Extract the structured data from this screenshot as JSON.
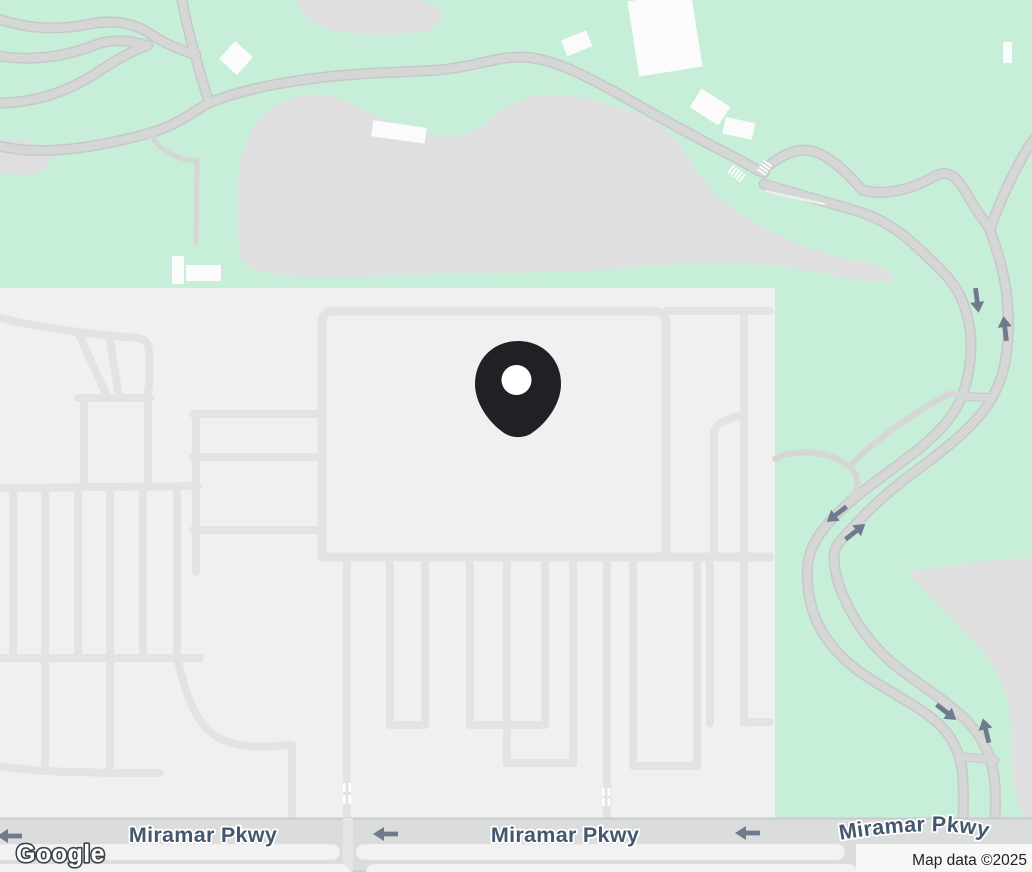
{
  "map": {
    "type": "google-maps-embed",
    "road_labels": [
      {
        "id": "miramar-pkwy-left",
        "text": "Miramar Pkwy"
      },
      {
        "id": "miramar-pkwy-center",
        "text": "Miramar Pkwy"
      },
      {
        "id": "miramar-pkwy-right",
        "text": "Miramar Pkwy"
      }
    ],
    "icons": {
      "marker": "location-pin",
      "road_arrows": "one-way-arrow",
      "crosswalk": "crosswalk-ticks"
    }
  },
  "branding": {
    "logo_text": "Google"
  },
  "attribution": {
    "text": "Map data ©2025"
  },
  "colors": {
    "park_green": "#c7eed8",
    "terrain_gray": "#dfdfdf",
    "residential_gray": "#f0f0f0",
    "street_gray": "#e3e3e4",
    "road_fill": "#d5d6d6",
    "road_casing": "#c7c8c8",
    "pkwy_fill": "#dbdcdc",
    "median_fill": "#f2f2f2",
    "arrow_slate": "#6f7b8d",
    "label_blue_gray": "#44586d",
    "building_white": "#fbfbfb",
    "pin_black": "#202124",
    "attribution_text": "#212121"
  }
}
